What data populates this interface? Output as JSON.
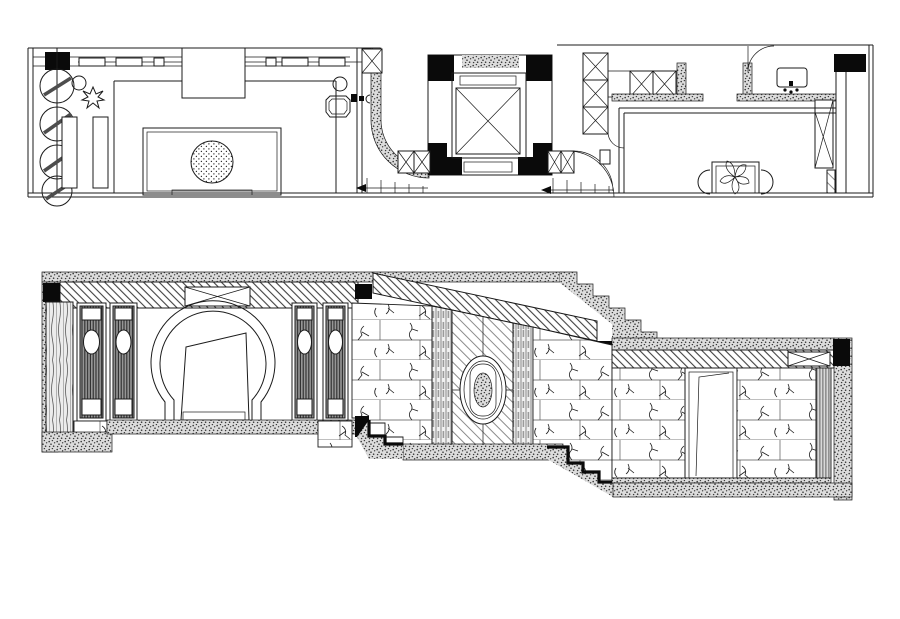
{
  "canvas": {
    "width_px": 900,
    "height_px": 619,
    "background": "#ffffff",
    "ink": "#1b1b1b"
  },
  "colors": {
    "black_fill": "#0a0a0a",
    "stipple_base": "#dcdcdc",
    "stipple_dot": "#3a3a3a",
    "panel_stripe_base": "#969696",
    "hatch_stroke": "#414141"
  },
  "views": {
    "floor_plan": {
      "label": "floor plan strip (top view)"
    },
    "elevation": {
      "label": "interior elevation / section (bottom view)"
    }
  }
}
